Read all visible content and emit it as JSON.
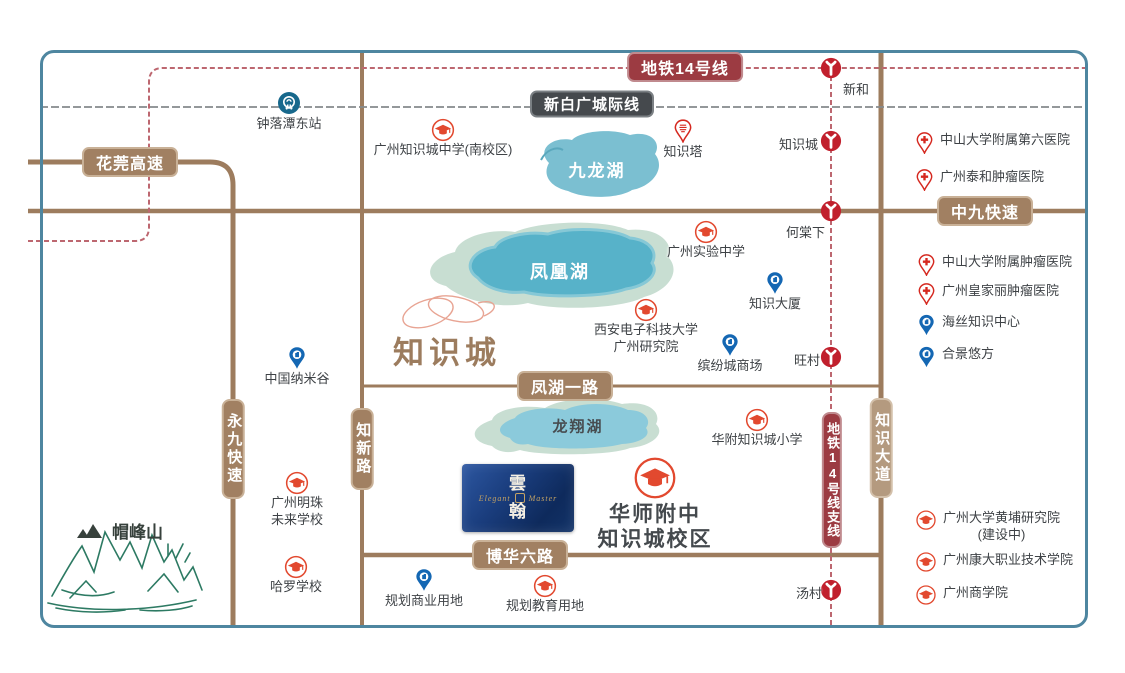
{
  "map": {
    "region_label": "知识城",
    "mountain": "帽峰山",
    "lakes": {
      "jiulong": "九龙湖",
      "fenghuang": "凤凰湖",
      "longxiang": "龙翔湖"
    },
    "roads": {
      "huawan": "花莞高速",
      "zhongjiu": "中九快速",
      "fenghu": "凤湖一路",
      "bohua": "博华六路",
      "yongjiu": "永九快速",
      "zhixin": "知新路",
      "zhishidadao": "知识大道"
    },
    "transit": {
      "line14": "地铁14号线",
      "line14_branch": "地铁14号线支线",
      "intercity": "新白广城际线",
      "rail_station": "钟落潭东站",
      "stations": {
        "xinhe": "新和",
        "zhishicheng": "知识城",
        "hetangxia": "何棠下",
        "wangcun": "旺村",
        "tangcun": "汤村"
      }
    },
    "pois": {
      "zsc_middle_school": {
        "label": "广州知识城中学(南校区)"
      },
      "knowledge_tower": {
        "label": "知识塔"
      },
      "gz_experimental_school": {
        "label": "广州实验中学"
      },
      "knowledge_building": {
        "label": "知识大厦"
      },
      "xidian_university": {
        "line1": "西安电子科技大学",
        "line2": "广州研究院"
      },
      "binfencheng_mall": {
        "label": "缤纷城商场"
      },
      "nano_valley": {
        "label": "中国纳米谷"
      },
      "hfzsc_primary": {
        "label": "华附知识城小学"
      },
      "hsfz_campus": {
        "line1": "华师附中",
        "line2": "知识城校区"
      },
      "mingzhu_school": {
        "line1": "广州明珠",
        "line2": "未来学校"
      },
      "harrow_school": {
        "label": "哈罗学校"
      },
      "planned_commercial": {
        "label": "规划商业用地"
      },
      "planned_education": {
        "label": "规划教育用地"
      }
    },
    "side_panel": {
      "items": [
        {
          "label": "中山大学附属第六医院",
          "type": "hospital"
        },
        {
          "label": "广州泰和肿瘤医院",
          "type": "hospital"
        },
        {
          "label": "中山大学附属肿瘤医院",
          "type": "hospital"
        },
        {
          "label": "广州皇家丽肿瘤医院",
          "type": "hospital"
        },
        {
          "label": "海丝知识中心",
          "type": "landmark"
        },
        {
          "label": "合景悠方",
          "type": "landmark"
        },
        {
          "label": "广州大学黄埔研究院",
          "label2": "(建设中)",
          "type": "school"
        },
        {
          "label": "广州康大职业技术学院",
          "type": "school"
        },
        {
          "label": "广州商学院",
          "type": "school"
        }
      ]
    },
    "project": {
      "cn_top": "雲",
      "cn_bottom": "翰",
      "en_left": "Elegant",
      "en_right": "Master"
    },
    "colors": {
      "road": "#9d7c5e",
      "metro_badge": "#9c3b42",
      "metro_line": "#bd6770",
      "intercity_line": "#85898c",
      "station": "#c1202d",
      "frame": "#4e86a0",
      "lake_core": "#57b2c9",
      "lake_halo": "#c8ded2",
      "school_icon": "#e2492f",
      "hospital_icon": "#d5281f",
      "landmark_icon": "#1467b3",
      "rail_station_icon": "#17688c"
    }
  }
}
